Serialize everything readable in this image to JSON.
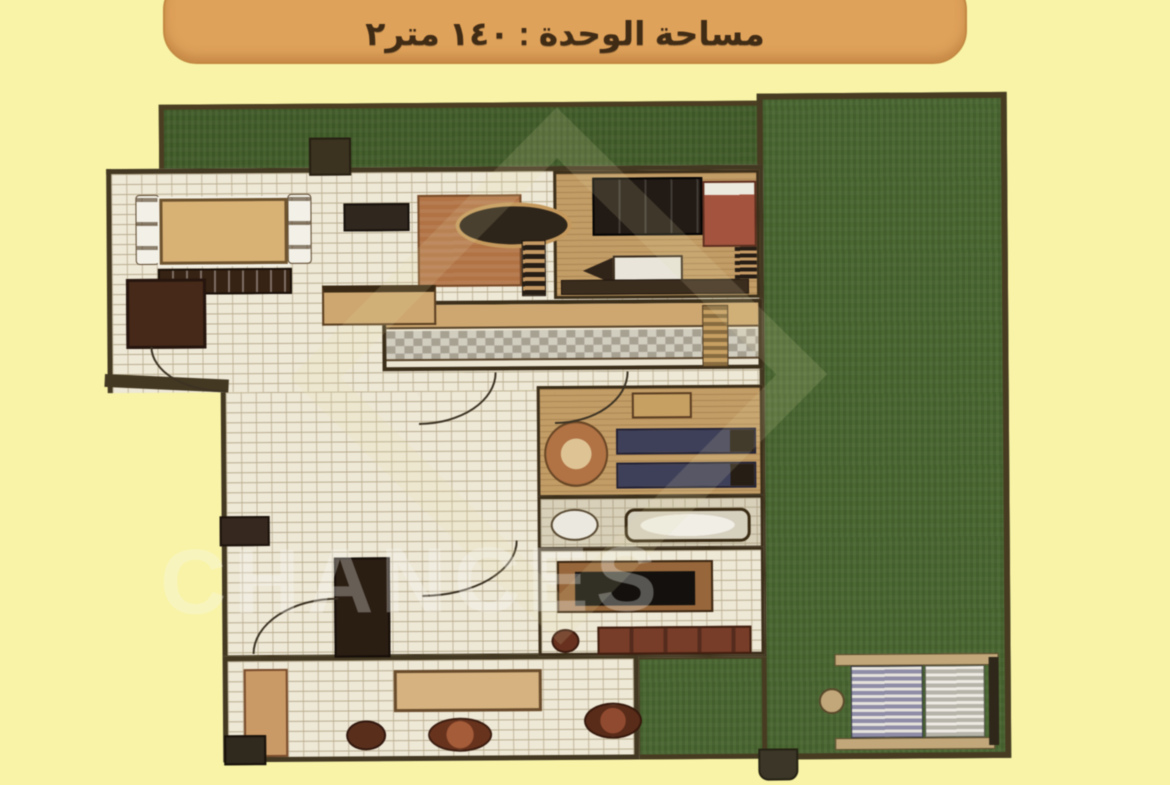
{
  "banner": {
    "text": "مساحة الوحدة : ١٤٠ متر٢",
    "label": "مساحة الوحدة",
    "area_value": "١٤٠",
    "area_unit": "متر٢"
  },
  "watermark": {
    "text": "CHANCES"
  },
  "colors": {
    "page_background": "#f8f3a6",
    "banner_background": "#e5a355",
    "banner_text": "#3f2810",
    "garden_green": "#47662c",
    "wall_brown": "#42361d",
    "floor_cream": "#f2ebd8",
    "wood_floor": "#c79e62",
    "furniture_dark": "#36200f",
    "sofa_red": "#7a3a24",
    "bed_navy": "#3c3e5a",
    "fixture_white": "#efebe1",
    "pergola_tan": "#c4a876"
  }
}
